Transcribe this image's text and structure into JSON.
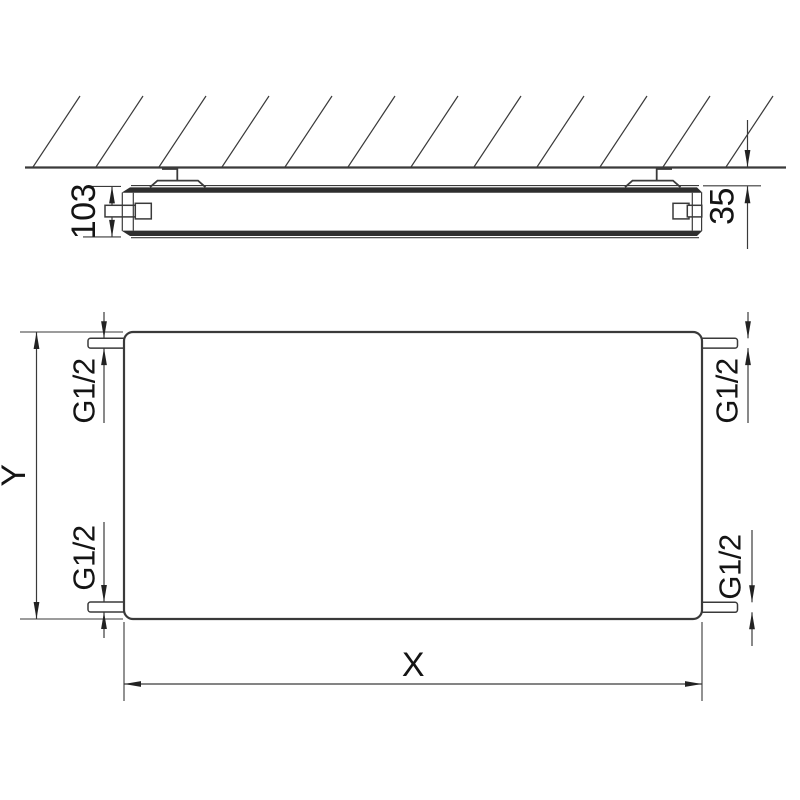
{
  "colors": {
    "background": "#ffffff",
    "line": "#3a3a3a",
    "panel_fill": "#2e2e2e",
    "text": "#141414"
  },
  "side_view": {
    "depth_dimension": "103",
    "wall_distance_dimension": "35"
  },
  "front_view": {
    "width_dimension": "X",
    "height_dimension": "Y",
    "connections": {
      "top_left": "G1/2",
      "top_right": "G1/2",
      "bottom_left": "G1/2",
      "bottom_right": "G1/2"
    }
  }
}
